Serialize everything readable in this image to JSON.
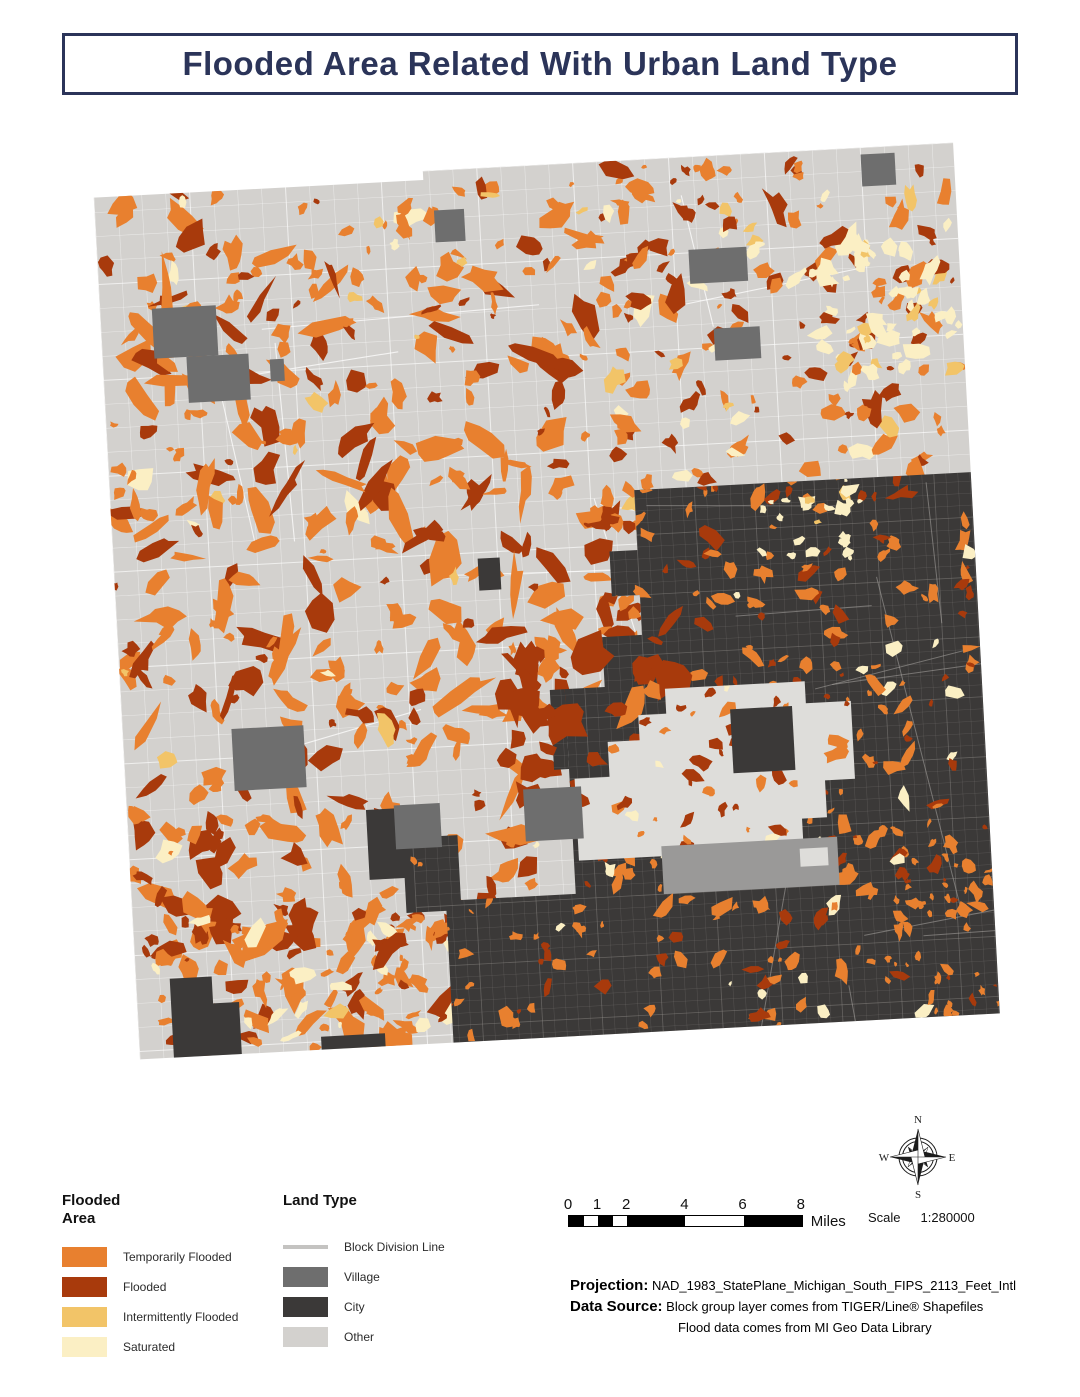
{
  "title": "Flooded Area Related With Urban Land Type",
  "palette": {
    "temporarily": "#E8802F",
    "flooded": "#A83A0C",
    "intermittently": "#F2C468",
    "saturated": "#FBEFC4",
    "village": "#6E6E6E",
    "city": "#3B3938",
    "other": "#D3D1CE",
    "enclave": "#DEDDDA",
    "village_band": "#9A9998",
    "block_line": "#C4C3C1",
    "navy": "#2B3459"
  },
  "legend_flooded": {
    "title": "Flooded Area",
    "items": [
      {
        "label": "Temporarily Flooded",
        "color_key": "temporarily"
      },
      {
        "label": "Flooded",
        "color_key": "flooded"
      },
      {
        "label": "Intermittently Flooded",
        "color_key": "intermittently"
      },
      {
        "label": "Saturated",
        "color_key": "saturated"
      }
    ]
  },
  "legend_land": {
    "title": "Land Type",
    "items": [
      {
        "label": "Block Division Line",
        "color_key": "block_line",
        "shape": "line"
      },
      {
        "label": "Village",
        "color_key": "village",
        "shape": "rect"
      },
      {
        "label": "City",
        "color_key": "city",
        "shape": "rect"
      },
      {
        "label": "Other",
        "color_key": "other",
        "shape": "rect"
      }
    ]
  },
  "scalebar": {
    "ticks": [
      "0",
      "1",
      "2",
      "4",
      "6",
      "8"
    ],
    "tick_miles": [
      0,
      1,
      2,
      4,
      6,
      8
    ],
    "px_per_mile": 29.1,
    "black_segments_miles": [
      [
        0,
        0.5
      ],
      [
        1,
        1.5
      ],
      [
        2,
        4
      ],
      [
        6,
        8
      ]
    ],
    "unit_label": "Miles"
  },
  "scale_note": {
    "label": "Scale",
    "value": "1:280000"
  },
  "compass": {
    "n": "N",
    "e": "E",
    "s": "S",
    "w": "W"
  },
  "footer": {
    "projection_label": "Projection:",
    "projection_value": "NAD_1983_StatePlane_Michigan_South_FIPS_2113_Feet_Intl",
    "source_label": "Data Source:",
    "source_value_1": "Block group layer comes from TIGER/Line® Shapefiles",
    "source_value_2": "Flood data comes from MI Geo Data Library"
  },
  "map": {
    "seed": 1337,
    "rotation_deg": -3.07,
    "grid_light": {
      "step": 24,
      "stroke": "#ffffff",
      "opacity": 0.5,
      "width": 0.55,
      "major_every": 4,
      "major_width": 1.0,
      "major_opacity": 0.65
    },
    "grid_city": {
      "step": 12,
      "stroke": "#989490",
      "opacity": 0.3,
      "width": 0.45,
      "major_every": 5,
      "major_width": 0.8,
      "major_opacity": 0.45
    },
    "roads": [
      {
        "clip": "square",
        "count": 12,
        "color": "#ffffff",
        "width": 1.1,
        "opacity": 0.75,
        "region": [
          120,
          170,
          850,
          760
        ],
        "lmin": 100,
        "lmax": 320
      },
      {
        "clip": "city",
        "count": 12,
        "color": "#b5b2ae",
        "width": 1.0,
        "opacity": 0.5,
        "region": [
          610,
          480,
          367,
          540
        ],
        "lmin": 120,
        "lmax": 360
      }
    ],
    "fields": [
      {
        "layer": "light",
        "region": [
          116,
          175,
          530,
          860
        ],
        "count": 340,
        "rmin": 2,
        "rmax": 12,
        "elong": 2.4,
        "colors": [
          [
            "temporarily",
            0.58
          ],
          [
            "flooded",
            0.3
          ],
          [
            "intermittently",
            0.07
          ],
          [
            "saturated",
            0.05
          ]
        ]
      },
      {
        "layer": "light",
        "region": [
          140,
          240,
          480,
          620
        ],
        "count": 120,
        "rmin": 3,
        "rmax": 8,
        "elong": 5,
        "colors": [
          [
            "temporarily",
            0.72
          ],
          [
            "flooded",
            0.28
          ]
        ]
      },
      {
        "layer": "light",
        "region": [
          620,
          170,
          357,
          320
        ],
        "count": 160,
        "rmin": 2,
        "rmax": 9,
        "elong": 2.2,
        "colors": [
          [
            "temporarily",
            0.42
          ],
          [
            "flooded",
            0.36
          ],
          [
            "saturated",
            0.12
          ],
          [
            "intermittently",
            0.1
          ]
        ]
      },
      {
        "layer": "light",
        "region": [
          830,
          240,
          145,
          150
        ],
        "count": 48,
        "rmin": 2.5,
        "rmax": 9,
        "elong": 1.7,
        "colors": [
          [
            "saturated",
            0.78
          ],
          [
            "intermittently",
            0.22
          ]
        ]
      },
      {
        "layer": "light",
        "region": [
          128,
          835,
          160,
          100
        ],
        "count": 15,
        "rmin": 5,
        "rmax": 15,
        "elong": 1.9,
        "colors": [
          [
            "flooded",
            0.85
          ],
          [
            "temporarily",
            0.15
          ]
        ]
      },
      {
        "layer": "light",
        "region": [
          130,
          895,
          330,
          135
        ],
        "count": 90,
        "rmin": 2,
        "rmax": 8,
        "elong": 2.6,
        "colors": [
          [
            "temporarily",
            0.66
          ],
          [
            "flooded",
            0.2
          ],
          [
            "saturated",
            0.14
          ]
        ]
      },
      {
        "layer": "light",
        "region": [
          600,
          480,
          80,
          180
        ],
        "count": 30,
        "rmin": 3,
        "rmax": 10,
        "elong": 2,
        "colors": [
          [
            "temporarily",
            0.5
          ],
          [
            "flooded",
            0.5
          ]
        ]
      },
      {
        "layer": "city",
        "region": [
          610,
          480,
          367,
          420
        ],
        "count": 190,
        "rmin": 1.5,
        "rmax": 7,
        "elong": 2.3,
        "colors": [
          [
            "temporarily",
            0.58
          ],
          [
            "flooded",
            0.34
          ],
          [
            "saturated",
            0.08
          ]
        ]
      },
      {
        "layer": "city",
        "region": [
          755,
          492,
          115,
          85
        ],
        "count": 24,
        "rmin": 2,
        "rmax": 6.5,
        "elong": 1.5,
        "colors": [
          [
            "saturated",
            0.85
          ],
          [
            "intermittently",
            0.15
          ]
        ]
      },
      {
        "layer": "city",
        "region": [
          400,
          850,
          580,
          187
        ],
        "count": 130,
        "rmin": 1.5,
        "rmax": 7,
        "elong": 2.1,
        "colors": [
          [
            "temporarily",
            0.62
          ],
          [
            "flooded",
            0.26
          ],
          [
            "saturated",
            0.12
          ]
        ]
      },
      {
        "layer": "city",
        "region": [
          850,
          900,
          127,
          137
        ],
        "count": 20,
        "rmin": 1.5,
        "rmax": 5,
        "elong": 1.8,
        "colors": [
          [
            "temporarily",
            0.6
          ],
          [
            "flooded",
            0.4
          ]
        ]
      },
      {
        "layer": "mid",
        "region": [
          490,
          645,
          190,
          150
        ],
        "count": 30,
        "rmin": 5,
        "rmax": 19,
        "elong": 1.7,
        "colors": [
          [
            "flooded",
            0.8
          ],
          [
            "temporarily",
            0.2
          ]
        ]
      },
      {
        "layer": "enclave",
        "region": [
          565,
          690,
          285,
          175
        ],
        "count": 55,
        "rmin": 1.5,
        "rmax": 7,
        "elong": 1.8,
        "colors": [
          [
            "flooded",
            0.5
          ],
          [
            "temporarily",
            0.4
          ],
          [
            "saturated",
            0.1
          ]
        ]
      }
    ]
  }
}
